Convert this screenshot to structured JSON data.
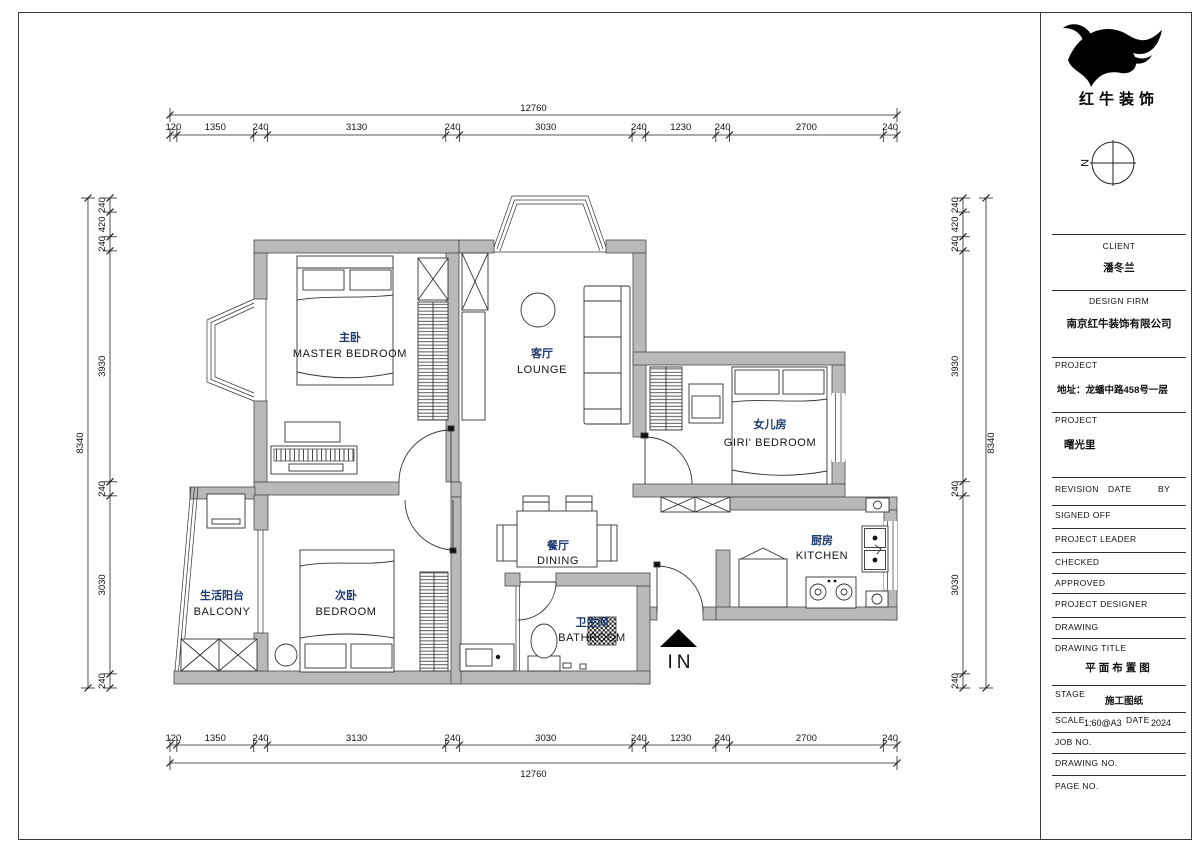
{
  "colors": {
    "wall_fill": "#b9b9b9",
    "room_label_cn": "#1d3a70"
  },
  "logo": {
    "company_cn": "红牛装饰"
  },
  "north_indicator": {
    "label": "N"
  },
  "rooms": [
    {
      "id": "master-bedroom",
      "name_cn": "主卧",
      "name_en": "MASTER BEDROOM"
    },
    {
      "id": "lounge",
      "name_cn": "客厅",
      "name_en": "LOUNGE"
    },
    {
      "id": "girls-bedroom",
      "name_cn": "女儿房",
      "name_en": "GIRI' BEDROOM"
    },
    {
      "id": "dining",
      "name_cn": "餐厅",
      "name_en": "DINING"
    },
    {
      "id": "kitchen",
      "name_cn": "厨房",
      "name_en": "KITCHEN"
    },
    {
      "id": "bathroom",
      "name_cn": "卫生间",
      "name_en": "BATHROOM"
    },
    {
      "id": "second-bedroom",
      "name_cn": "次卧",
      "name_en": "BEDROOM"
    },
    {
      "id": "balcony",
      "name_cn": "生活阳台",
      "name_en": "BALCONY"
    }
  ],
  "entrance": {
    "label": "IN"
  },
  "dimensions": {
    "horizontal_total": "12760",
    "horizontal_segments": [
      "120",
      "1350",
      "240",
      "3130",
      "240",
      "3030",
      "240",
      "1230",
      "240",
      "2700",
      "240"
    ],
    "vertical_total": "8340",
    "vertical_segments": [
      "240",
      "420",
      "240",
      "3930",
      "240",
      "3030",
      "240"
    ]
  },
  "title_block": {
    "client_label": "CLIENT",
    "client": "潘冬兰",
    "design_firm_label": "DESIGN FIRM",
    "design_firm": "南京红牛装饰有限公司",
    "project_label": "PROJECT",
    "project_address": "地址：龙蟠中路458号一层",
    "project2_label": "PROJECT",
    "project_name": "曙光里",
    "revision_label": "REVISION",
    "date_label": "DATE",
    "by_label": "BY",
    "signed_off_label": "SIGNED OFF",
    "project_leader_label": "PROJECT LEADER",
    "checked_label": "CHECKED",
    "approved_label": "APPROVED",
    "project_designer_label": "PROJECT DESIGNER",
    "drawing_label": "DRAWING",
    "drawing_title_label": "DRAWING TITLE",
    "drawing_title": "平面布置图",
    "stage_label": "STAGE",
    "stage": "施工图纸",
    "scale_label": "SCALE",
    "scale": "1:60@A3",
    "date2_label": "DATE",
    "date": "2024",
    "job_no_label": "JOB NO.",
    "drawing_no_label": "DRAWING NO.",
    "page_no_label": "PAGE NO."
  }
}
